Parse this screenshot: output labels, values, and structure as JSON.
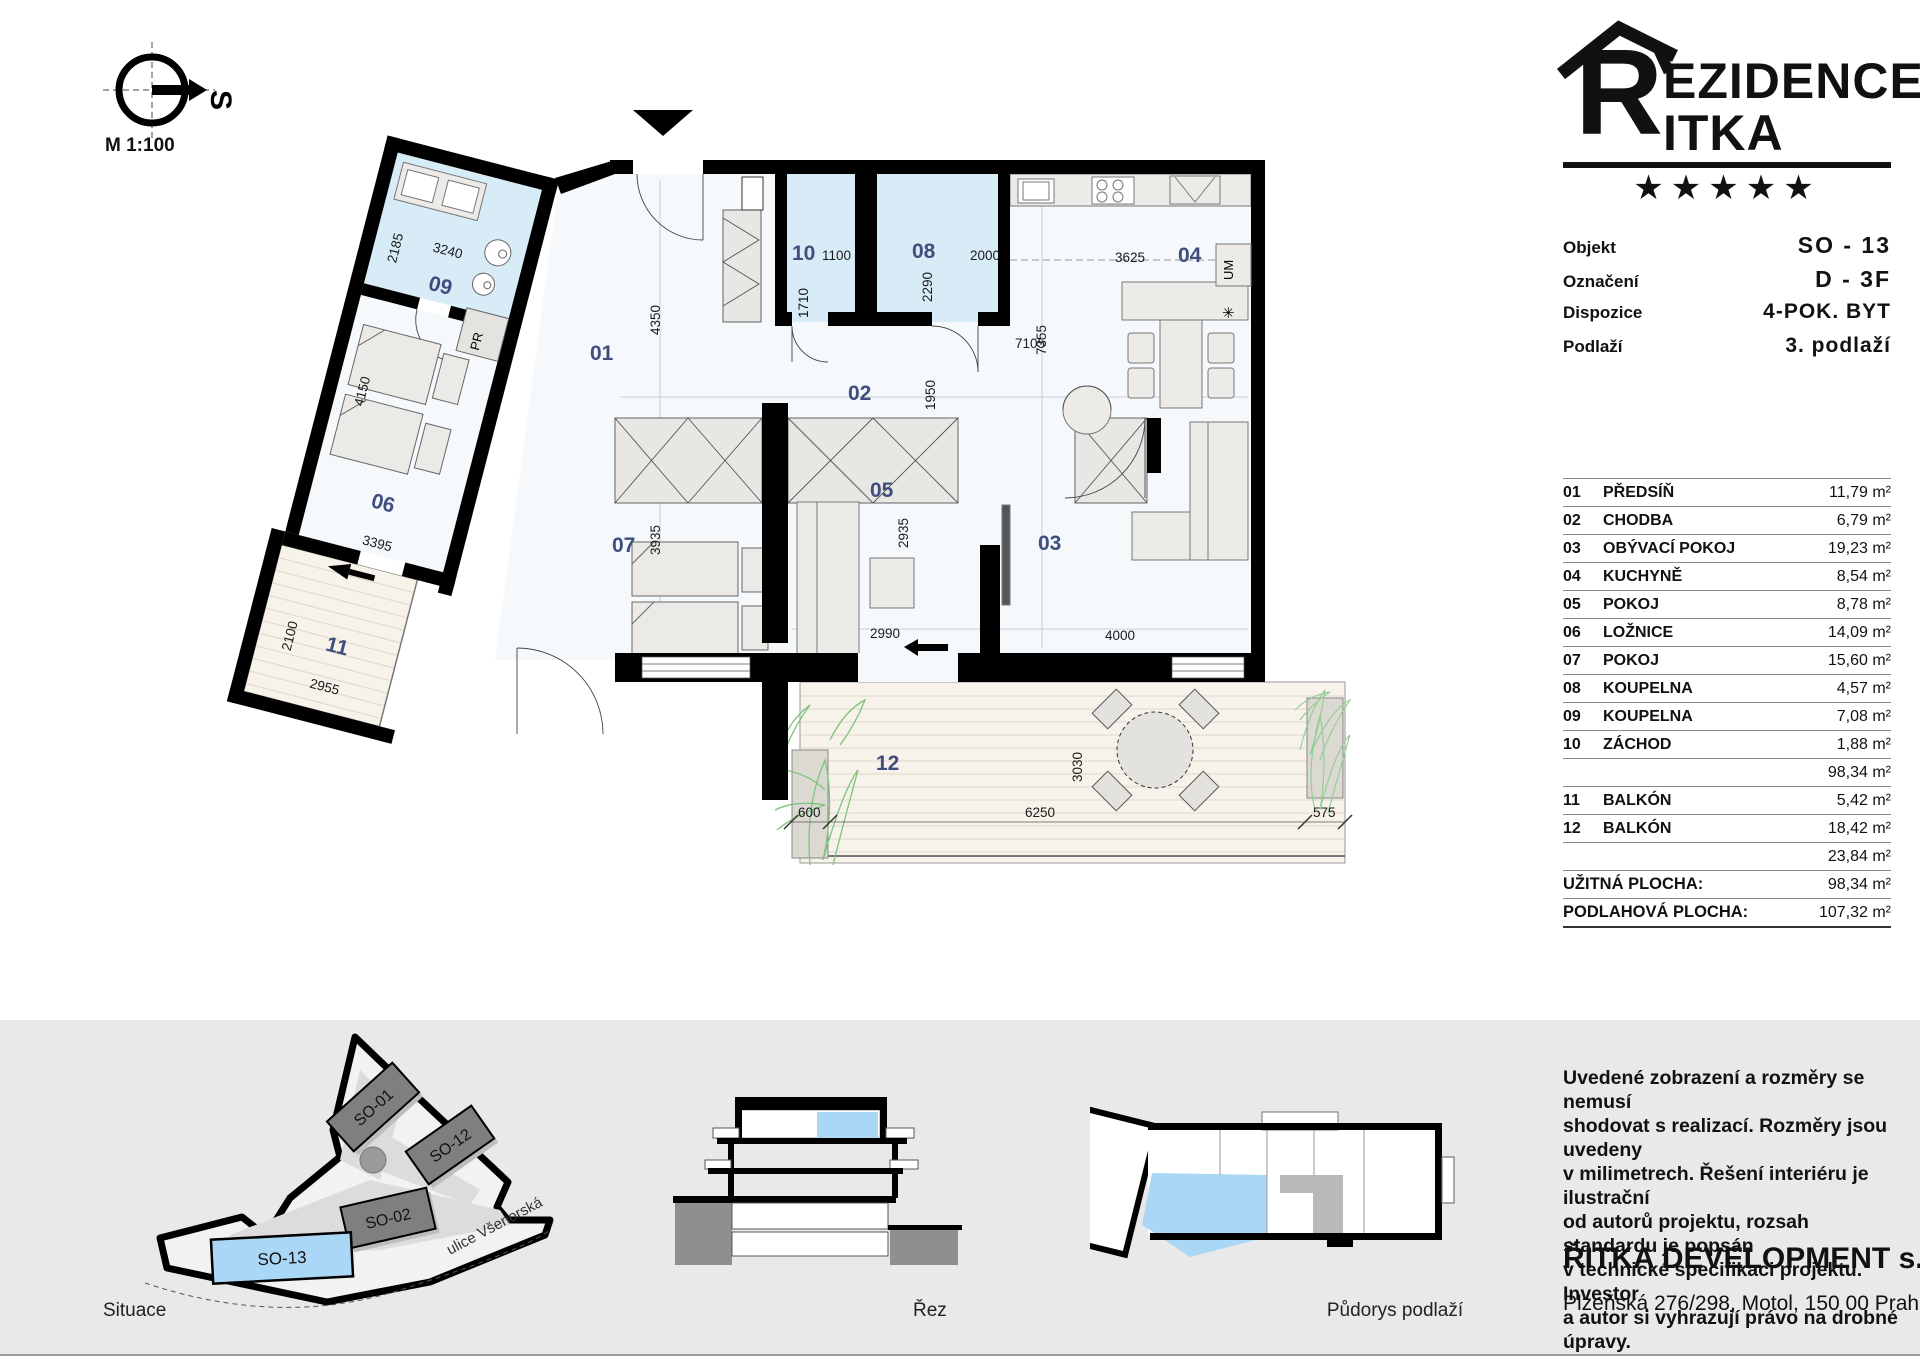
{
  "header": {
    "scale_label": "M 1:100",
    "compass_letter": "S"
  },
  "branding": {
    "initial": "R",
    "name_line1": "EZIDENCE",
    "name_line2": "ITKA",
    "stars": "★★★★★"
  },
  "unit_info": {
    "rows": [
      {
        "label": "Objekt",
        "value": "SO - 13"
      },
      {
        "label": "Označení",
        "value": "D - 3F"
      },
      {
        "label": "Dispozice",
        "value": "4-POK. BYT"
      },
      {
        "label": "Podlaží",
        "value": "3. podlaží"
      }
    ]
  },
  "room_table": {
    "rows": [
      {
        "num": "01",
        "name": "PŘEDSÍŇ",
        "area": "11,79 m²"
      },
      {
        "num": "02",
        "name": "CHODBA",
        "area": "6,79 m²"
      },
      {
        "num": "03",
        "name": "OBÝVACÍ POKOJ",
        "area": "19,23 m²"
      },
      {
        "num": "04",
        "name": "KUCHYNĚ",
        "area": "8,54 m²"
      },
      {
        "num": "05",
        "name": "POKOJ",
        "area": "8,78 m²"
      },
      {
        "num": "06",
        "name": "LOŽNICE",
        "area": "14,09 m²"
      },
      {
        "num": "07",
        "name": "POKOJ",
        "area": "15,60 m²"
      },
      {
        "num": "08",
        "name": "KOUPELNA",
        "area": "4,57 m²"
      },
      {
        "num": "09",
        "name": "KOUPELNA",
        "area": "7,08 m²"
      },
      {
        "num": "10",
        "name": "ZÁCHOD",
        "area": "1,88 m²"
      }
    ],
    "subtotal_main": "98,34 m²",
    "balcony_rows": [
      {
        "num": "11",
        "name": "BALKÓN",
        "area": "5,42 m²"
      },
      {
        "num": "12",
        "name": "BALKÓN",
        "area": "18,42 m²"
      }
    ],
    "subtotal_balcony": "23,84 m²",
    "totals": [
      {
        "label": "UŽITNÁ PLOCHA:",
        "value": "98,34 m²"
      },
      {
        "label": "PODLAHOVÁ PLOCHA:",
        "value": "107,32 m²"
      }
    ]
  },
  "plan": {
    "numbers": {
      "r01": "01",
      "r02": "02",
      "r03": "03",
      "r04": "04",
      "r05": "05",
      "r06": "06",
      "r07": "07",
      "r08": "08",
      "r09": "09",
      "r10": "10",
      "r11": "11",
      "r12": "12"
    },
    "dims": {
      "d3240": "3240",
      "d2185": "2185",
      "d4150": "4150",
      "d3395": "3395",
      "d2100": "2100",
      "d2955": "2955",
      "d4350": "4350",
      "d3935": "3935",
      "d1100": "1100",
      "d1710": "1710",
      "d2000": "2000",
      "d2290": "2290",
      "d3625": "3625",
      "d7105": "7105",
      "d1950": "1950",
      "d7355": "7355",
      "d2935": "2935",
      "d2990": "2990",
      "d4000": "4000",
      "d3030": "3030",
      "d600": "600",
      "d6250": "6250",
      "d575": "575"
    },
    "fixtures": {
      "pantry": "PR",
      "washer": "UM",
      "symbol": "✳"
    }
  },
  "footer": {
    "site": {
      "caption": "Situace",
      "buildings": [
        "SO-01",
        "SO-12",
        "SO-02"
      ],
      "highlight": "SO-13",
      "street": "ulice Všenorská"
    },
    "section": {
      "caption": "Řez"
    },
    "floor_mini": {
      "caption": "Půdorys podlaží"
    },
    "disclaimer_lines": [
      "Uvedené zobrazení a rozměry se nemusí",
      "shodovat s realizací. Rozměry jsou uvedeny",
      "v milimetrech. Řešení interiéru je ilustrační",
      "od autorů projektu, rozsah standardu je popsán",
      "v technické specifikaci projektu. Investor",
      "a autor si vyhrazují právo na drobné úpravy."
    ],
    "company": "ŘITKA DEVELOPMENT s.r.o.",
    "address": "Plzeňská 276/298, Motol, 150 00 Praha 5"
  },
  "colors": {
    "unit_highlight": "#a9d7f5",
    "bath_blue": "#d8ecf8",
    "balcony_deck": "#f7f2ea",
    "room_label": "#3f4e7d",
    "building_gray": "#7f7f7f"
  }
}
